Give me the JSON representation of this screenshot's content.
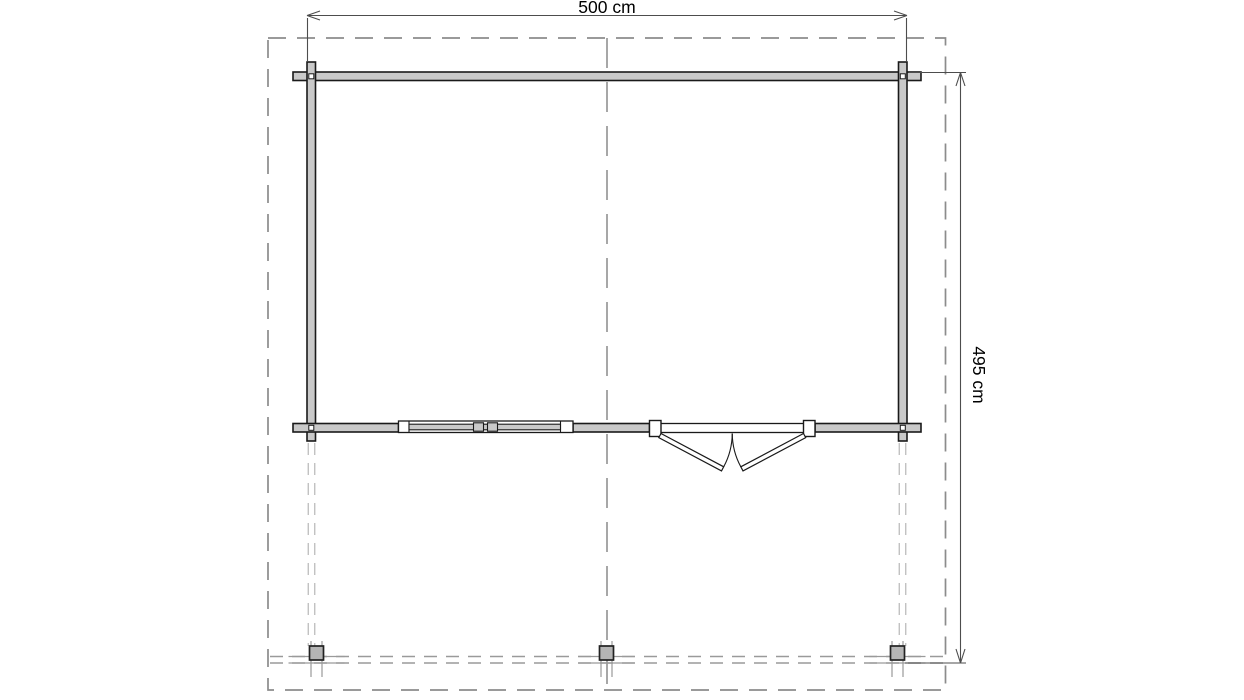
{
  "drawing": {
    "title": "Log cabin floor plan with terrace",
    "width_dimension": {
      "label": "500 cm",
      "value": 500,
      "unit": "cm"
    },
    "depth_dimension": {
      "label": "495 cm",
      "value": 495,
      "unit": "cm"
    },
    "colors": {
      "background": "#ffffff",
      "wall_fill": "#c9c9c9",
      "wall_stroke": "#1a1a1a",
      "opening_fill": "#ffffff",
      "dashed_outline": "#8c8c8c",
      "axis_line": "#8a8a8a",
      "hidden_line": "#a9a9a9",
      "deck_line": "#9a9a9a",
      "dimension_line": "#4d4d4d",
      "text": "#000000",
      "post_fill": "#b5b5b5",
      "post_stroke": "#222222"
    },
    "elements": {
      "roof_overhang": "dashed-roof-outline",
      "walls": "log-walls-crossed-corners",
      "window": "window-symbol",
      "door": "outward-opening-double-door",
      "posts": "terrace-posts-x3",
      "deck_edge": "terrace-front-edge-hidden-lines"
    }
  }
}
